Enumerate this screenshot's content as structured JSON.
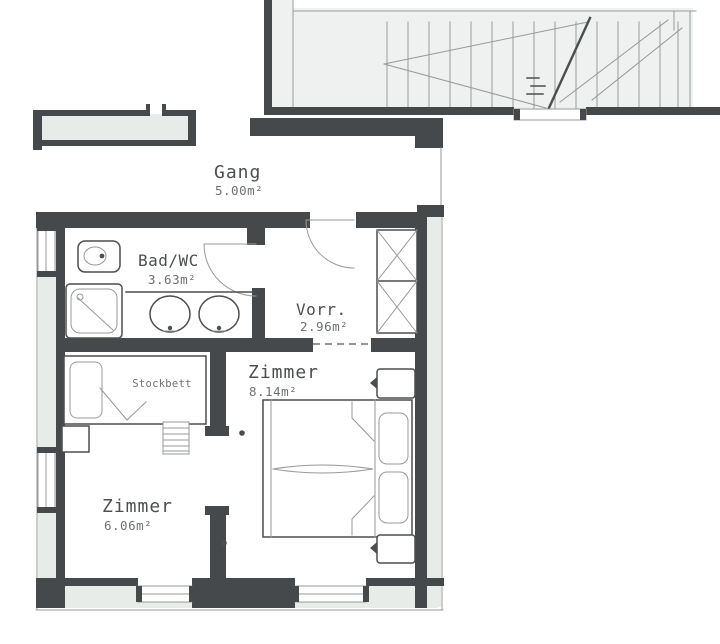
{
  "rooms": {
    "gang": {
      "name": "Gang",
      "area": "5.00m²"
    },
    "bad_wc": {
      "name": "Bad/WC",
      "area": "3.63m²"
    },
    "vorraum": {
      "name": "Vorr.",
      "area": "2.96m²"
    },
    "zimmer_right": {
      "name": "Zimmer",
      "area": "8.14m²"
    },
    "zimmer_left": {
      "name": "Zimmer",
      "area": "6.06m²"
    }
  },
  "furniture": {
    "bunk_bed_label": "Stockbett"
  },
  "colors": {
    "bg": "#ffffff",
    "ink": "#4b4f4d",
    "ink2": "#6e7270",
    "ink3": "#979a98",
    "wall": "#46494b",
    "wallFill": "#e8ece9",
    "stairFill": "#eef1ef"
  }
}
